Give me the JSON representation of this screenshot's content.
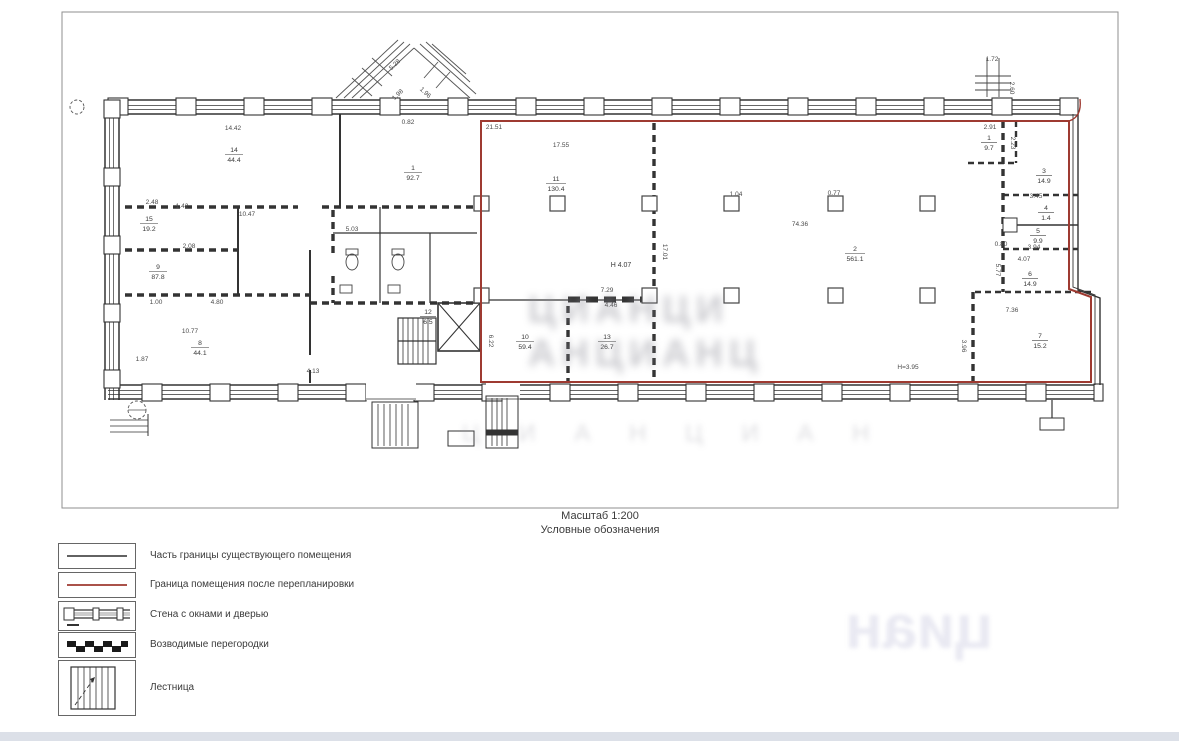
{
  "document": {
    "scale_label": "Масштаб 1:200",
    "legend_title": "Условные обозначения"
  },
  "colors": {
    "boundary_new": "#9e3a31",
    "boundary_existing": "#2f2f2f",
    "wall": "#333333",
    "frame": "#8f8f8f"
  },
  "legend": {
    "items": [
      {
        "symbol": "existing-boundary-line",
        "label": "Часть границы существующего помещения"
      },
      {
        "symbol": "new-boundary-line",
        "label": "Граница помещения после перепланировки"
      },
      {
        "symbol": "wall-with-windows-and-door",
        "label": "Стена с окнами и дверью"
      },
      {
        "symbol": "new-partitions",
        "label": "Возводимые перегородки"
      },
      {
        "symbol": "stairs",
        "label": "Лестница"
      }
    ]
  },
  "plan": {
    "dims": [
      {
        "text": "14.42"
      },
      {
        "text": "5.28"
      },
      {
        "text": "1.98"
      },
      {
        "text": "1.96"
      },
      {
        "text": "0.82"
      },
      {
        "text": "21.51"
      },
      {
        "text": "17.55"
      },
      {
        "text": "1.72"
      },
      {
        "text": "2.60"
      },
      {
        "text": "2.91"
      },
      {
        "text": "2.23"
      },
      {
        "text": "10.47"
      },
      {
        "text": "2.48"
      },
      {
        "text": "1.42"
      },
      {
        "text": "2.08"
      },
      {
        "text": "1.00"
      },
      {
        "text": "4.80"
      },
      {
        "text": "10.77"
      },
      {
        "text": "1.87"
      },
      {
        "text": "5.03"
      },
      {
        "text": "7.29"
      },
      {
        "text": "4.46"
      },
      {
        "text": "4.13"
      },
      {
        "text": "6.22"
      },
      {
        "text": "74.36"
      },
      {
        "text": "H 4.07"
      },
      {
        "text": "17.01"
      },
      {
        "text": "1.04"
      },
      {
        "text": "0.77"
      },
      {
        "text": "3.45"
      },
      {
        "text": "0.80"
      },
      {
        "text": "4.07"
      },
      {
        "text": "3.94"
      },
      {
        "text": "5.77"
      },
      {
        "text": "Н=3.95"
      },
      {
        "text": "7.36"
      },
      {
        "text": "3.96"
      }
    ],
    "rooms": [
      {
        "number": "14",
        "area": "44.4"
      },
      {
        "number": "1",
        "area": "92.7"
      },
      {
        "number": "15",
        "area": "19.2"
      },
      {
        "number": "9",
        "area": "87.8"
      },
      {
        "number": "8",
        "area": "44.1"
      },
      {
        "number": "11",
        "area": "130.4"
      },
      {
        "number": "12",
        "area": "6.5"
      },
      {
        "number": "10",
        "area": "59.4"
      },
      {
        "number": "13",
        "area": "26.7"
      },
      {
        "number": "2",
        "area": "561.1"
      },
      {
        "number": "1",
        "area": "9.7"
      },
      {
        "number": "3",
        "area": "14.9"
      },
      {
        "number": "4",
        "area": "1.4"
      },
      {
        "number": "5",
        "area": "9.9"
      },
      {
        "number": "6",
        "area": "14.9"
      },
      {
        "number": "7",
        "area": "15.2"
      }
    ]
  },
  "watermark": {
    "row1": "ЦИАНЦИ",
    "row2": "АНЦИАНЦ",
    "row3": "Ц И А Н Ц И А Н",
    "legend_mark": "циан"
  }
}
